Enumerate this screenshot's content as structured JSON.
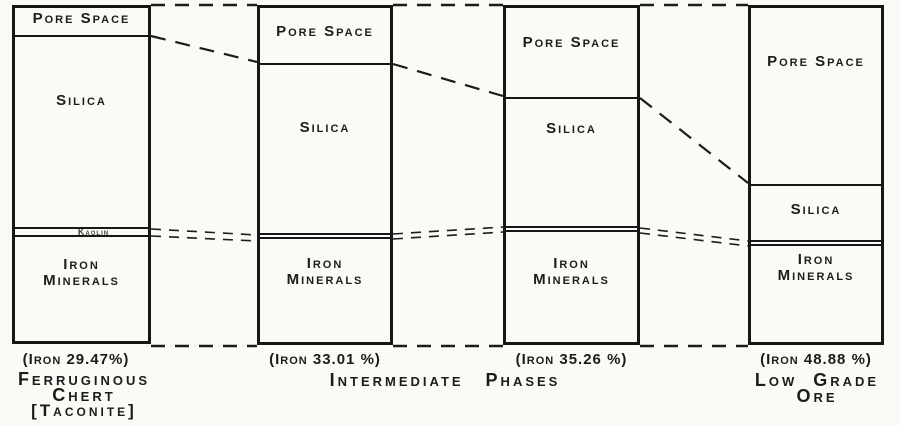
{
  "colors": {
    "ink": "#1c1c1c",
    "paper": "#fbfaf6"
  },
  "columns": [
    {
      "name": "ferruginous-chert-taconite",
      "labels": {
        "pore": "Pore Space",
        "silica": "Silica",
        "kaolin": "Kaolin",
        "iron1": "Iron",
        "iron2": "Minerals"
      },
      "caption": "(Iron 29.47%)"
    },
    {
      "name": "intermediate-phase-1",
      "labels": {
        "pore": "Pore Space",
        "silica": "Silica",
        "iron1": "Iron",
        "iron2": "Minerals"
      },
      "caption": "(Iron 33.01 %)"
    },
    {
      "name": "intermediate-phase-2",
      "labels": {
        "pore": "Pore Space",
        "silica": "Silica",
        "iron1": "Iron",
        "iron2": "Minerals"
      },
      "caption": "(Iron 35.26 %)"
    },
    {
      "name": "low-grade-ore",
      "labels": {
        "pore": "Pore Space",
        "silica": "Silica",
        "iron1": "Iron",
        "iron2": "Minerals"
      },
      "caption": "(Iron 48.88 %)"
    }
  ],
  "group_labels": {
    "left_line1": "Ferruginous",
    "left_line2": "Chert",
    "left_line3": "[Taconite]",
    "middle": "Intermediate Phases",
    "right_line1": "Low Grade",
    "right_line2": "Ore"
  },
  "chart_data": {
    "type": "bar",
    "subtype": "stacked-percent-columns",
    "title": "",
    "categories": [
      "Ferruginous Chert [Taconite]",
      "Intermediate Phase 1",
      "Intermediate Phase 2",
      "Low Grade Ore"
    ],
    "series": [
      {
        "name": "Pore Space",
        "values": [
          8.8,
          17.1,
          27.1,
          52.6
        ]
      },
      {
        "name": "Silica",
        "values": [
          56.9,
          50.0,
          37.9,
          16.5
        ]
      },
      {
        "name": "Kaolin",
        "values": [
          2.4,
          1.5,
          1.5,
          1.5
        ]
      },
      {
        "name": "Iron Minerals",
        "values": [
          31.9,
          31.4,
          33.5,
          29.4
        ]
      }
    ],
    "iron_percent": [
      29.47,
      33.01,
      35.26,
      48.88
    ],
    "annotations": [
      "(Iron 29.47%)",
      "(Iron 33.01 %)",
      "(Iron 35.26 %)",
      "(Iron 48.88 %)"
    ],
    "ylim": [
      0,
      100
    ],
    "grid": false,
    "legend": "none",
    "notes": "Segment boundaries of adjacent columns are linked by dashed connector lines; tops and bottoms of columns linked by horizontal dashed lines."
  }
}
